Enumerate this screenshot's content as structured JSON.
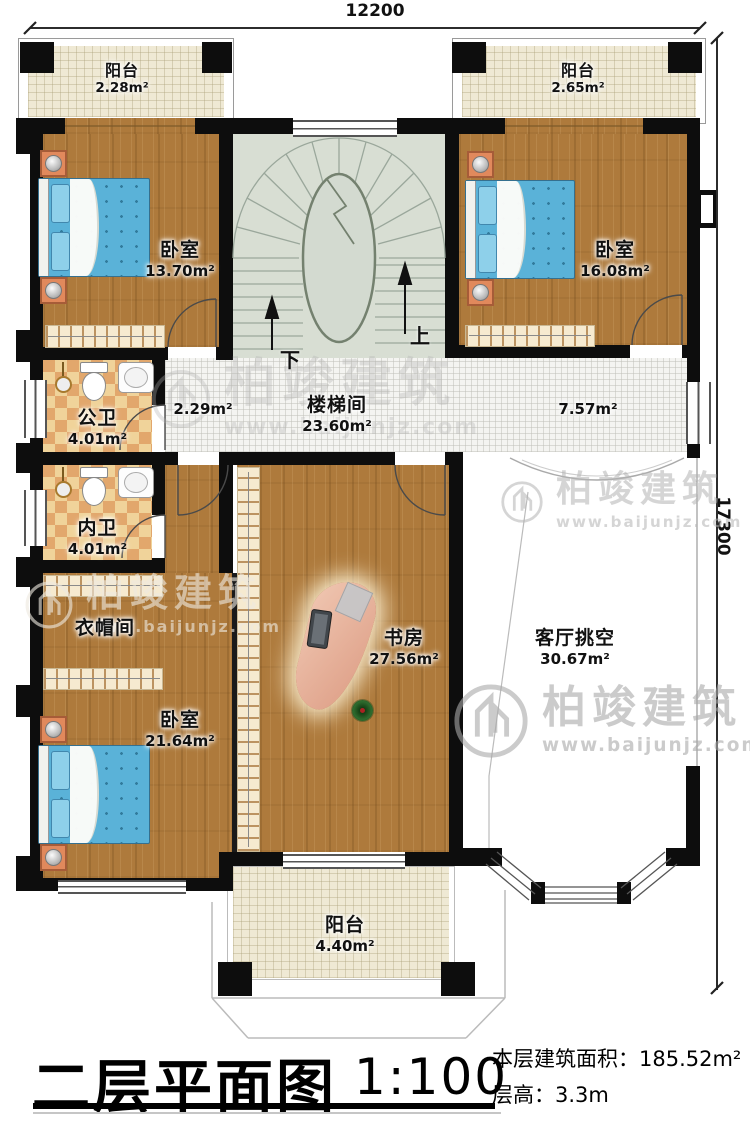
{
  "dims": {
    "width": "12200",
    "height": "17300"
  },
  "title": {
    "text": "二层平面图",
    "scale": "1:100",
    "area_label": "本层建筑面积：",
    "area_value": "185.52m²",
    "height_label": "层高：",
    "height_value": "3.3m"
  },
  "watermark": {
    "brand": "柏竣建筑",
    "url": "www.baijunjz.com"
  },
  "stairs": {
    "up": "上",
    "down": "下"
  },
  "rooms": {
    "balcony_tl": {
      "name": "阳台",
      "area": "2.28m²"
    },
    "balcony_tr": {
      "name": "阳台",
      "area": "2.65m²"
    },
    "bedroom_tl": {
      "name": "卧室",
      "area": "13.70m²"
    },
    "bedroom_tr": {
      "name": "卧室",
      "area": "16.08m²"
    },
    "bath_public": {
      "name": "公卫",
      "area": "4.01m²"
    },
    "bath_inner": {
      "name": "内卫",
      "area": "4.01m²"
    },
    "stairwell": {
      "name": "楼梯间",
      "area": "23.60m²"
    },
    "cloakroom": {
      "name": "衣帽间"
    },
    "bedroom_bl": {
      "name": "卧室",
      "area": "21.64m²"
    },
    "study": {
      "name": "书房",
      "area": "27.56m²"
    },
    "living_void": {
      "name": "客厅挑空",
      "area": "30.67m²"
    },
    "balcony_bottom": {
      "name": "阳台",
      "area": "4.40m²"
    },
    "hall_left": {
      "area": "2.29m²"
    },
    "hall_right": {
      "area": "7.57m²"
    }
  }
}
